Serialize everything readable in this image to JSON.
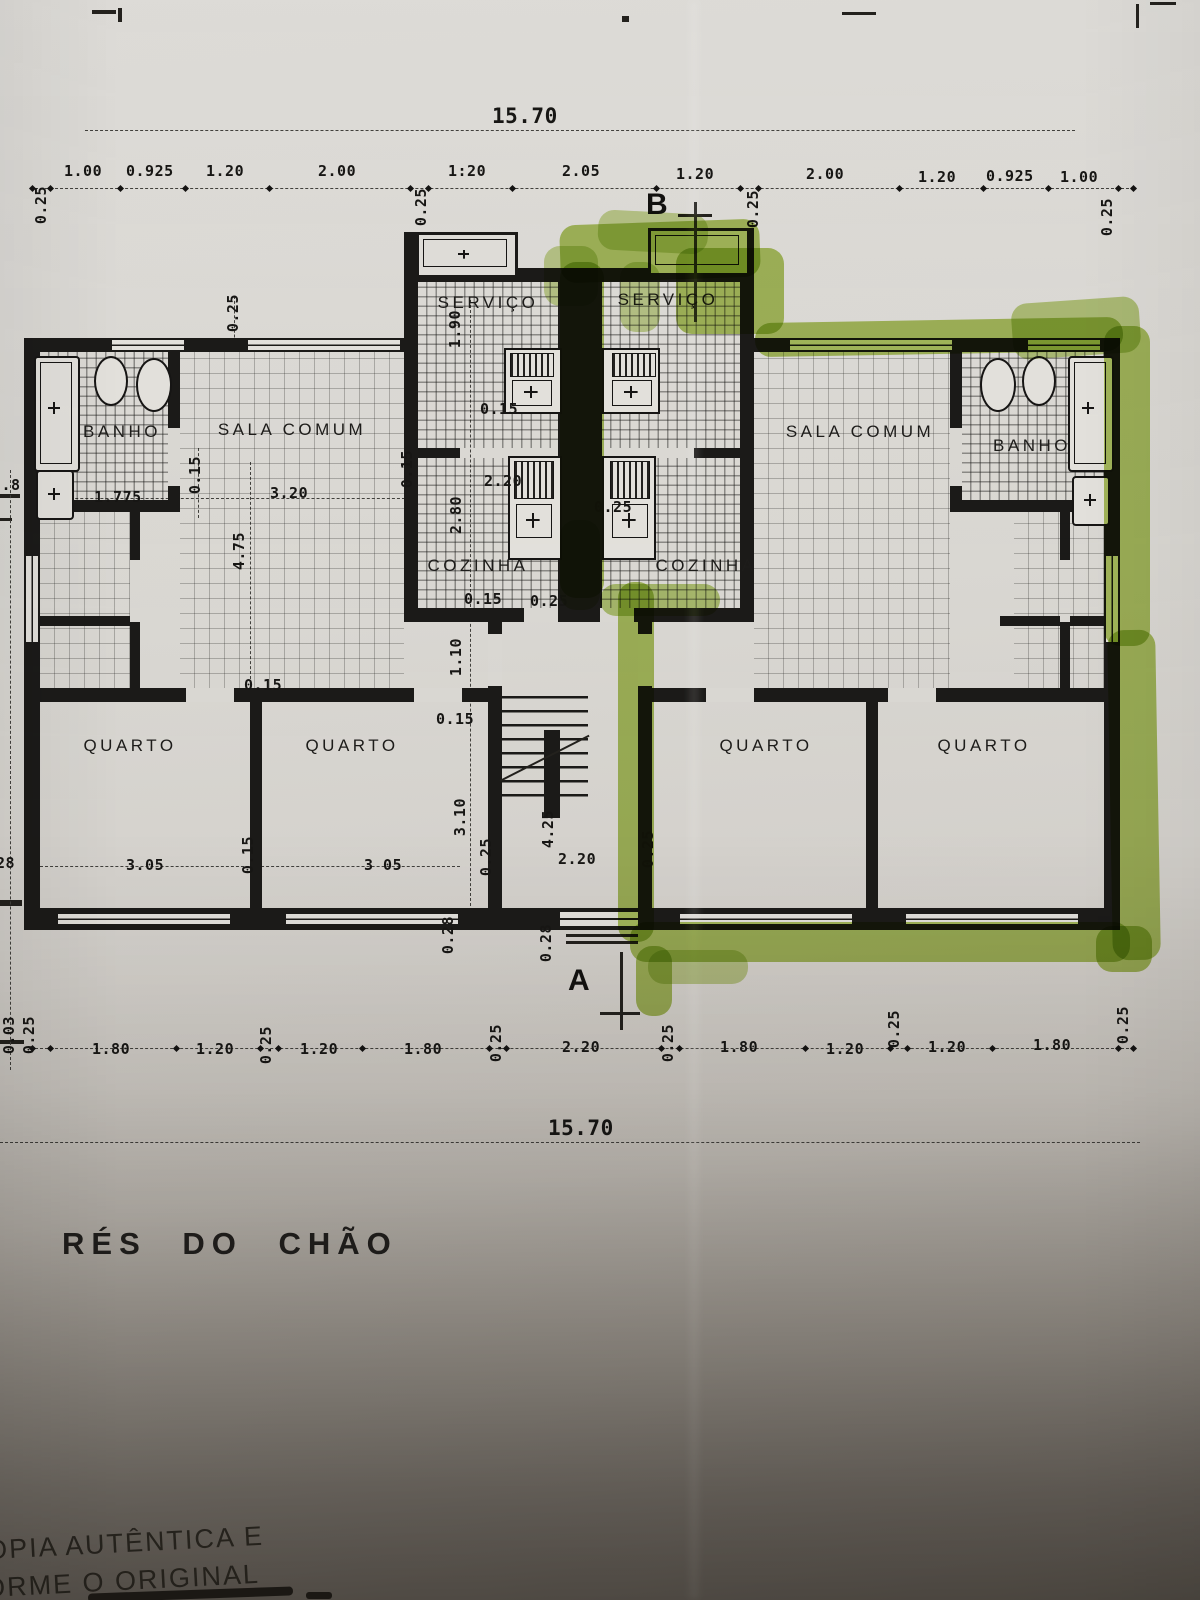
{
  "colors": {
    "paper": "#d9d7d2",
    "ink": "#1b1a18",
    "highlighter": "#9dbd3a"
  },
  "title": "RÉS DO CHÃO",
  "stamp": {
    "line1": "OPIA AUTÊNTICA E",
    "line2": "ORME O ORIGINAL"
  },
  "overall_width_top": "15.70",
  "overall_width_bottom": "15.70",
  "marker_labels": [
    {
      "t": "B",
      "x": 646,
      "y": 188
    },
    {
      "t": "A",
      "x": 568,
      "y": 964
    }
  ],
  "room_labels": [
    {
      "t": "SERVIÇO",
      "x": 488,
      "y": 293
    },
    {
      "t": "SERVIÇO",
      "x": 668,
      "y": 290
    },
    {
      "t": "BANHO",
      "x": 122,
      "y": 422
    },
    {
      "t": "SALA COMUM",
      "x": 292,
      "y": 420
    },
    {
      "t": "SALA COMUM",
      "x": 860,
      "y": 422
    },
    {
      "t": "BANHO",
      "x": 1032,
      "y": 436
    },
    {
      "t": "COZINHA",
      "x": 478,
      "y": 556
    },
    {
      "t": "COZINHA",
      "x": 706,
      "y": 556
    },
    {
      "t": "QUARTO",
      "x": 130,
      "y": 736
    },
    {
      "t": "QUARTO",
      "x": 352,
      "y": 736
    },
    {
      "t": "QUARTO",
      "x": 766,
      "y": 736
    },
    {
      "t": "QUARTO",
      "x": 984,
      "y": 736
    }
  ],
  "dim_labels": [
    {
      "t": "15.70",
      "x": 492,
      "y": 104,
      "s": 21
    },
    {
      "t": "1.00",
      "x": 64,
      "y": 162
    },
    {
      "t": "0.925",
      "x": 126,
      "y": 162
    },
    {
      "t": "1.20",
      "x": 206,
      "y": 162
    },
    {
      "t": "2.00",
      "x": 318,
      "y": 162
    },
    {
      "t": "1:20",
      "x": 448,
      "y": 162
    },
    {
      "t": "2.05",
      "x": 562,
      "y": 162
    },
    {
      "t": "1.20",
      "x": 676,
      "y": 165
    },
    {
      "t": "2.00",
      "x": 806,
      "y": 165
    },
    {
      "t": "1.20",
      "x": 918,
      "y": 168
    },
    {
      "t": "0.925",
      "x": 986,
      "y": 167
    },
    {
      "t": "1.00",
      "x": 1060,
      "y": 168
    },
    {
      "t": "0.25",
      "x": 32,
      "y": 186,
      "v": 1
    },
    {
      "t": "0.25",
      "x": 412,
      "y": 188,
      "v": 1
    },
    {
      "t": "0.25",
      "x": 744,
      "y": 190,
      "v": 1
    },
    {
      "t": "0.25",
      "x": 1098,
      "y": 198,
      "v": 1
    },
    {
      "t": "0.25",
      "x": 224,
      "y": 294,
      "v": 1
    },
    {
      "t": "1.90",
      "x": 446,
      "y": 310,
      "v": 1
    },
    {
      "t": "0.15",
      "x": 480,
      "y": 400
    },
    {
      "t": "2.8",
      "x": -8,
      "y": 476
    },
    {
      "t": "1.775",
      "x": 94,
      "y": 488
    },
    {
      "t": "0.15",
      "x": 186,
      "y": 456,
      "v": 1
    },
    {
      "t": "3.20",
      "x": 270,
      "y": 484
    },
    {
      "t": "0.15",
      "x": 398,
      "y": 450,
      "v": 1
    },
    {
      "t": "4.75",
      "x": 230,
      "y": 532,
      "v": 1
    },
    {
      "t": "2.20",
      "x": 484,
      "y": 472
    },
    {
      "t": "2.80",
      "x": 447,
      "y": 496,
      "v": 1
    },
    {
      "t": "0.25",
      "x": 594,
      "y": 498
    },
    {
      "t": "0.15",
      "x": 464,
      "y": 590
    },
    {
      "t": "0.25",
      "x": 530,
      "y": 592
    },
    {
      "t": "1.10",
      "x": 447,
      "y": 638,
      "v": 1
    },
    {
      "t": "0.15",
      "x": 244,
      "y": 676
    },
    {
      "t": "0.15",
      "x": 436,
      "y": 710
    },
    {
      "t": "3.05",
      "x": 126,
      "y": 856
    },
    {
      "t": "0.15",
      "x": 239,
      "y": 836,
      "v": 1
    },
    {
      "t": "3 05",
      "x": 364,
      "y": 856
    },
    {
      "t": "3.10",
      "x": 451,
      "y": 798,
      "v": 1
    },
    {
      "t": "0.25",
      "x": 477,
      "y": 838,
      "v": 1
    },
    {
      "t": "4.25",
      "x": 539,
      "y": 810,
      "v": 1
    },
    {
      "t": "2.20",
      "x": 558,
      "y": 850
    },
    {
      "t": "0.25",
      "x": 639,
      "y": 830,
      "v": 1
    },
    {
      "t": "0.28",
      "x": 439,
      "y": 916,
      "v": 1
    },
    {
      "t": "0.28",
      "x": 537,
      "y": 924,
      "v": 1
    },
    {
      "t": "28",
      "x": -4,
      "y": 854
    },
    {
      "t": "0.03",
      "x": 0,
      "y": 1016,
      "v": 1
    },
    {
      "t": "0.25",
      "x": 20,
      "y": 1016,
      "v": 1
    },
    {
      "t": "1.80",
      "x": 92,
      "y": 1040
    },
    {
      "t": "1.20",
      "x": 196,
      "y": 1040
    },
    {
      "t": "0.25",
      "x": 257,
      "y": 1026,
      "v": 1
    },
    {
      "t": "1.20",
      "x": 300,
      "y": 1040
    },
    {
      "t": "1.80",
      "x": 404,
      "y": 1040
    },
    {
      "t": "0.25",
      "x": 487,
      "y": 1024,
      "v": 1
    },
    {
      "t": "2.20",
      "x": 562,
      "y": 1038
    },
    {
      "t": "0.25",
      "x": 659,
      "y": 1024,
      "v": 1
    },
    {
      "t": "1.80",
      "x": 720,
      "y": 1038
    },
    {
      "t": "1.20",
      "x": 826,
      "y": 1040
    },
    {
      "t": "0.25",
      "x": 885,
      "y": 1010,
      "v": 1
    },
    {
      "t": "1.20",
      "x": 928,
      "y": 1038
    },
    {
      "t": "1.80",
      "x": 1033,
      "y": 1036
    },
    {
      "t": "0.25",
      "x": 1114,
      "y": 1006,
      "v": 1
    },
    {
      "t": "15.70",
      "x": 548,
      "y": 1116,
      "s": 21
    }
  ]
}
